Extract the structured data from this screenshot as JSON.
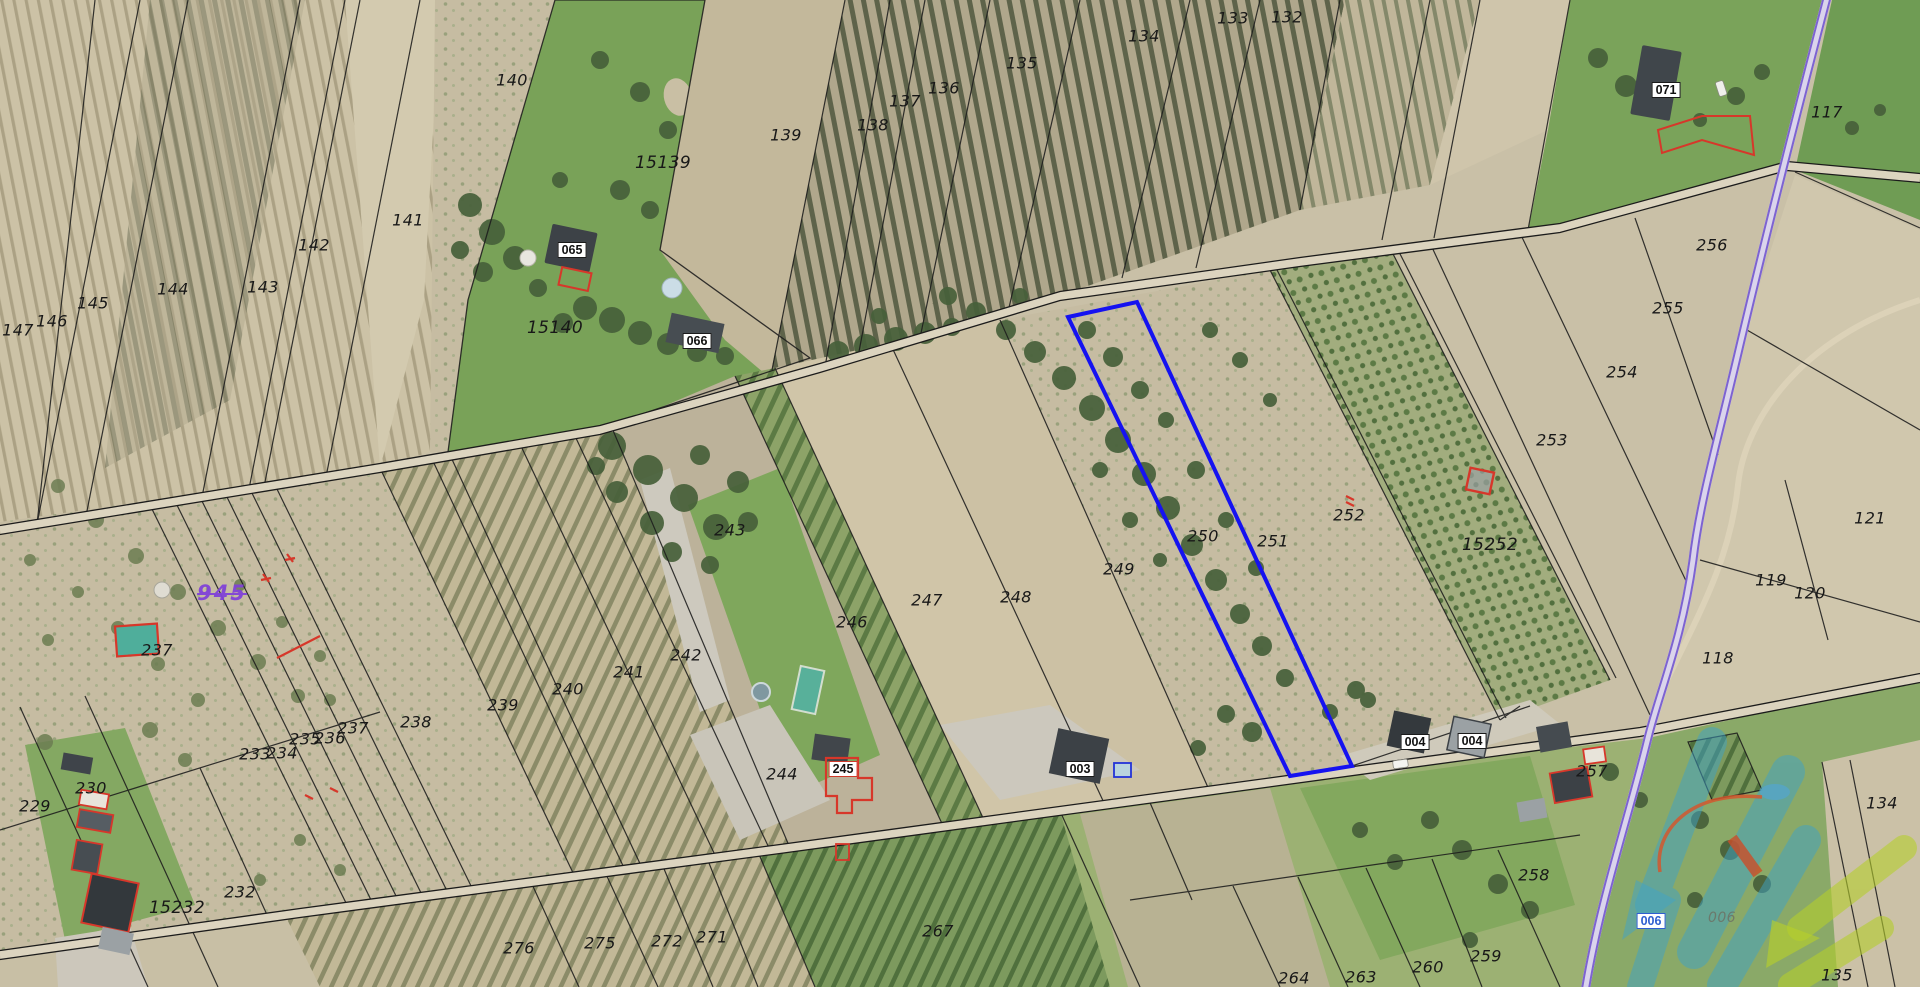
{
  "map": {
    "kind": "cadastral-aerial-view",
    "colors": {
      "selected_parcel_outline": "#1512f0",
      "highway_line": "#7d63d1",
      "parcel_line": "#1c1c1c",
      "building_outline_red": "#d7372a",
      "watermark_teal": "#3fa3c7",
      "watermark_green": "#b5ce2d",
      "watermark_orange": "#d2572e",
      "purple_label": "#8142d8"
    },
    "labels_plain": [
      {
        "t": "140",
        "x": 512,
        "y": 80
      },
      {
        "t": "141",
        "x": 408,
        "y": 220
      },
      {
        "t": "142",
        "x": 314,
        "y": 245
      },
      {
        "t": "143",
        "x": 263,
        "y": 287
      },
      {
        "t": "144",
        "x": 173,
        "y": 289
      },
      {
        "t": "145",
        "x": 93,
        "y": 303
      },
      {
        "t": "146",
        "x": 52,
        "y": 321
      },
      {
        "t": "147",
        "x": 18,
        "y": 330
      },
      {
        "t": "15139",
        "x": 663,
        "y": 163
      },
      {
        "t": "15140",
        "x": 555,
        "y": 328
      },
      {
        "t": "139",
        "x": 786,
        "y": 135
      },
      {
        "t": "138",
        "x": 873,
        "y": 125
      },
      {
        "t": "137",
        "x": 905,
        "y": 101
      },
      {
        "t": "136",
        "x": 944,
        "y": 88
      },
      {
        "t": "135",
        "x": 1022,
        "y": 63
      },
      {
        "t": "134",
        "x": 1144,
        "y": 36
      },
      {
        "t": "133",
        "x": 1233,
        "y": 18
      },
      {
        "t": "132",
        "x": 1287,
        "y": 17
      },
      {
        "t": "117",
        "x": 1827,
        "y": 112
      },
      {
        "t": "256",
        "x": 1712,
        "y": 245
      },
      {
        "t": "255",
        "x": 1668,
        "y": 308
      },
      {
        "t": "254",
        "x": 1622,
        "y": 372
      },
      {
        "t": "253",
        "x": 1552,
        "y": 440
      },
      {
        "t": "121",
        "x": 1870,
        "y": 518
      },
      {
        "t": "120",
        "x": 1810,
        "y": 593
      },
      {
        "t": "119",
        "x": 1771,
        "y": 580
      },
      {
        "t": "118",
        "x": 1718,
        "y": 658
      },
      {
        "t": "243",
        "x": 730,
        "y": 530
      },
      {
        "t": "238",
        "x": 416,
        "y": 722
      },
      {
        "t": "239",
        "x": 503,
        "y": 705
      },
      {
        "t": "240",
        "x": 568,
        "y": 689
      },
      {
        "t": "241",
        "x": 629,
        "y": 672
      },
      {
        "t": "242",
        "x": 686,
        "y": 655
      },
      {
        "t": "244",
        "x": 782,
        "y": 774
      },
      {
        "t": "246",
        "x": 852,
        "y": 622
      },
      {
        "t": "247",
        "x": 927,
        "y": 600
      },
      {
        "t": "248",
        "x": 1016,
        "y": 597
      },
      {
        "t": "249",
        "x": 1119,
        "y": 569
      },
      {
        "t": "250",
        "x": 1203,
        "y": 536
      },
      {
        "t": "251",
        "x": 1273,
        "y": 541
      },
      {
        "t": "252",
        "x": 1349,
        "y": 515
      },
      {
        "t": "15252",
        "x": 1490,
        "y": 545
      },
      {
        "t": "237",
        "x": 157,
        "y": 650
      },
      {
        "t": "233",
        "x": 255,
        "y": 754
      },
      {
        "t": "234",
        "x": 282,
        "y": 753
      },
      {
        "t": "235",
        "x": 305,
        "y": 739
      },
      {
        "t": "236",
        "x": 330,
        "y": 738
      },
      {
        "t": "237",
        "x": 353,
        "y": 728
      },
      {
        "t": "229",
        "x": 35,
        "y": 806
      },
      {
        "t": "230",
        "x": 91,
        "y": 788
      },
      {
        "t": "232",
        "x": 240,
        "y": 892
      },
      {
        "t": "15232",
        "x": 177,
        "y": 908
      },
      {
        "t": "276",
        "x": 519,
        "y": 948
      },
      {
        "t": "275",
        "x": 600,
        "y": 943
      },
      {
        "t": "272",
        "x": 667,
        "y": 941
      },
      {
        "t": "271",
        "x": 712,
        "y": 937
      },
      {
        "t": "267",
        "x": 938,
        "y": 931
      },
      {
        "t": "257",
        "x": 1592,
        "y": 771
      },
      {
        "t": "258",
        "x": 1534,
        "y": 875
      },
      {
        "t": "259",
        "x": 1486,
        "y": 956
      },
      {
        "t": "260",
        "x": 1428,
        "y": 967
      },
      {
        "t": "263",
        "x": 1361,
        "y": 977
      },
      {
        "t": "264",
        "x": 1294,
        "y": 978
      },
      {
        "t": "134",
        "x": 1882,
        "y": 803
      },
      {
        "t": "135",
        "x": 1837,
        "y": 975
      }
    ],
    "labels_boxed": [
      {
        "t": "065",
        "x": 572,
        "y": 250
      },
      {
        "t": "066",
        "x": 697,
        "y": 341
      },
      {
        "t": "071",
        "x": 1666,
        "y": 90
      },
      {
        "t": "003",
        "x": 1080,
        "y": 769
      },
      {
        "t": "004",
        "x": 1415,
        "y": 742
      },
      {
        "t": "004",
        "x": 1472,
        "y": 741
      },
      {
        "t": "245",
        "x": 843,
        "y": 769,
        "b": "#d03a2a"
      },
      {
        "t": "006",
        "x": 1651,
        "y": 921,
        "b": "#2e5fd0",
        "c": "#2e5fd0"
      }
    ],
    "labels_purple": [
      {
        "t": "945",
        "x": 222,
        "y": 593
      }
    ],
    "labels_faint": [
      {
        "t": "006",
        "x": 1722,
        "y": 918
      }
    ]
  }
}
